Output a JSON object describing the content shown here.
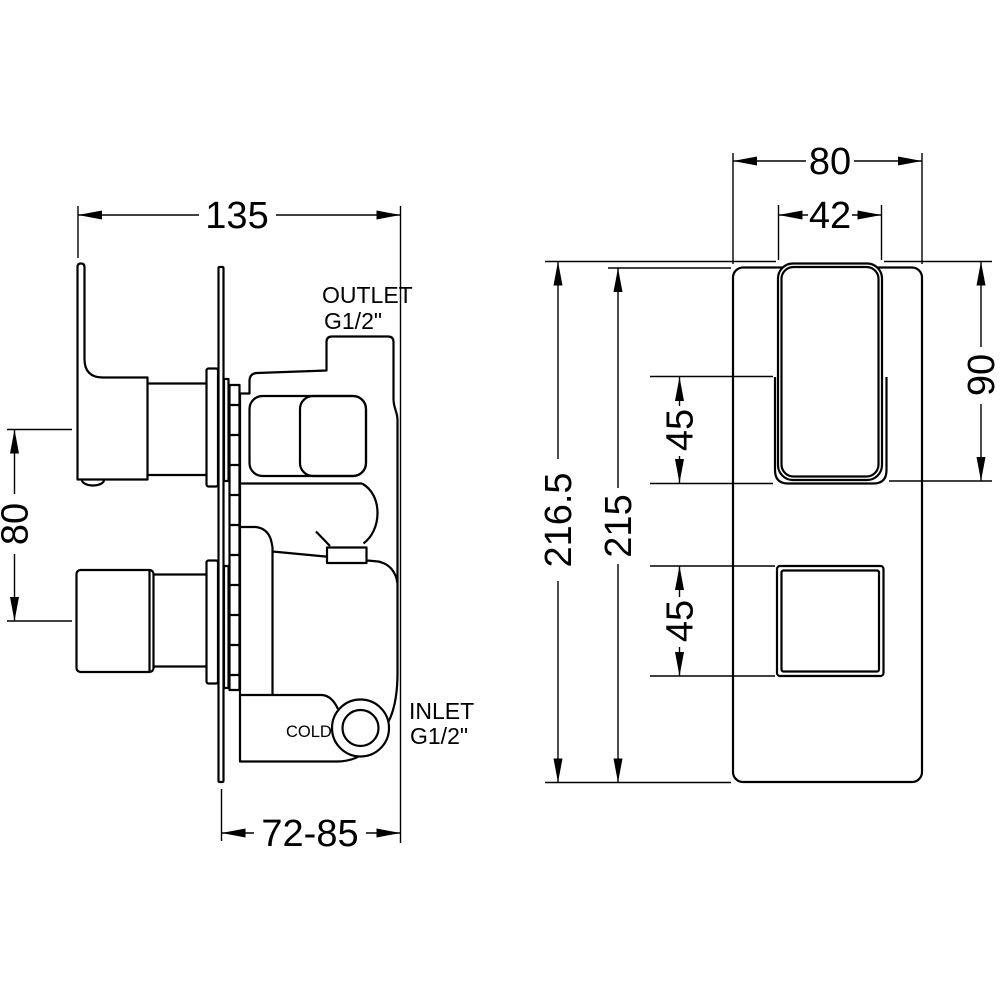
{
  "drawing": {
    "background_color": "#ffffff",
    "line_color": "#000000",
    "side_view": {
      "dim_width": "135",
      "dim_handle_spacing": "80",
      "dim_depth": "72-85",
      "outlet_label": "OUTLET",
      "outlet_thread": "G1/2\"",
      "inlet_label": "INLET",
      "inlet_thread": "G1/2\"",
      "cold_label": "COLD"
    },
    "front_view": {
      "dim_plate_width": "80",
      "dim_handle_width": "42",
      "dim_total_height": "216.5",
      "dim_plate_height": "215",
      "dim_handle_height": "90",
      "dim_upper_recess": "45",
      "dim_lower_handle": "45"
    }
  }
}
